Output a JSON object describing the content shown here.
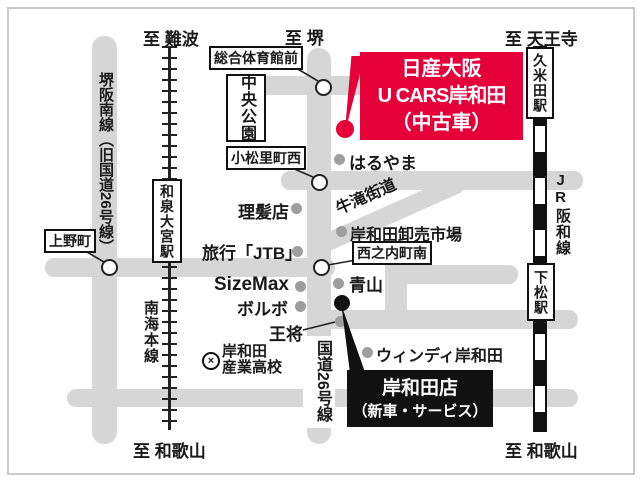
{
  "colors": {
    "accent_red": "#e5003a",
    "black_box": "#111111",
    "road_gray": "#d6d6d6"
  },
  "edges": {
    "namba": "至 難波",
    "sakai": "至 堺",
    "tennoji": "至 天王寺",
    "wakayama_left": "至 和歌山",
    "wakayama_right": "至 和歌山"
  },
  "roads": {
    "sakaihannan": "堺阪南線（旧国道26号線）",
    "route26": "国道26号線",
    "ushitaki": "牛滝街道"
  },
  "railways": {
    "nankai": "南海本線",
    "jr_lat": "JR",
    "jr_jp": "阪和線"
  },
  "stations": {
    "izumiomiya": "和泉大宮駅",
    "kumeda": "久米田駅",
    "shimomatsu": "下松駅"
  },
  "intersections": {
    "sogotaiikukanmae": "総合体育館前",
    "komatsurichonishi": "小松里町西",
    "uenocho": "上野町",
    "nishinouchichominami": "西之内町南"
  },
  "park": {
    "chuokoen": "中央公園"
  },
  "landmarks": [
    {
      "label": "はるやま"
    },
    {
      "label": "理髪店"
    },
    {
      "label": "岸和田卸売市場"
    },
    {
      "label": "旅行「JTB」"
    },
    {
      "label": "SizeMax"
    },
    {
      "label": "ボルボ"
    },
    {
      "label": "王将"
    },
    {
      "label": "青山"
    },
    {
      "label": "ウィンディ岸和田"
    }
  ],
  "school": {
    "line1": "岸和田",
    "line2": "産業高校"
  },
  "ucars_box": {
    "line1": "日産大阪",
    "line2": "U CARS岸和田",
    "line3": "（中古車）"
  },
  "kishiwada_box": {
    "line1": "岸和田店",
    "line2": "（新車・サービス）"
  }
}
